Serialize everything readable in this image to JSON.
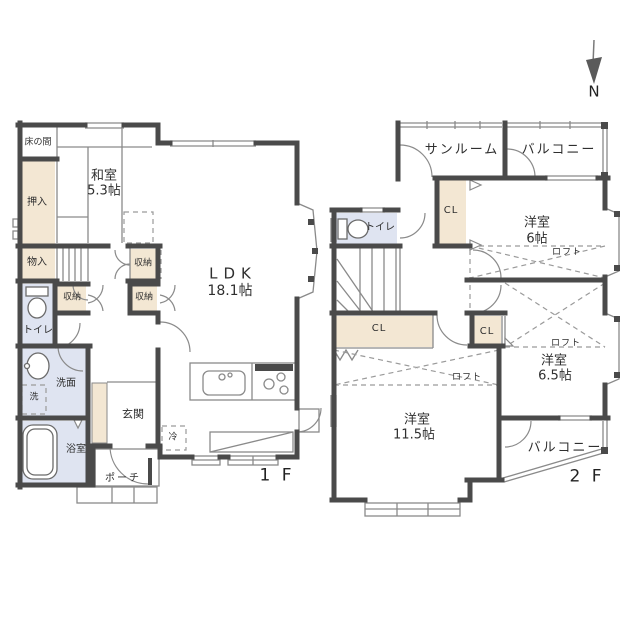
{
  "plan": {
    "floor1": {
      "label": "1 F",
      "tokonoma": "床の間",
      "washitsu_name": "和室",
      "washitsu_size": "5.3帖",
      "oshiire": "押入",
      "monoire": "物入",
      "closet1": "収納",
      "closet2": "収納",
      "closet3": "収納",
      "toilet": "トイレ",
      "washroom": "洗面",
      "washer": "洗",
      "bath": "浴室",
      "entrance": "玄関",
      "porch": "ポーチ",
      "ldk_name": "LDK",
      "ldk_size": "18.1帖",
      "fridge": "冷"
    },
    "floor2": {
      "label": "2 F",
      "sunroom": "サンルーム",
      "balcony_top": "バルコニー",
      "balcony_bottom": "バルコニー",
      "closet_upper": "CL",
      "closet_long": "CL",
      "closet_small": "CL",
      "toilet": "トイレ",
      "room6_name": "洋室",
      "room6_size": "6帖",
      "room65_name": "洋室",
      "room65_size": "6.5帖",
      "room115_name": "洋室",
      "room115_size": "11.5帖",
      "loft1": "ロフト",
      "loft2": "ロフト",
      "loft3": "ロフト"
    },
    "compass": {
      "north": "N"
    },
    "colors": {
      "wall": "#4a4a4a",
      "closet_fill": "#f3e7d3",
      "wet_fill": "#dfe4f1",
      "line": "#8a8a8a"
    }
  }
}
